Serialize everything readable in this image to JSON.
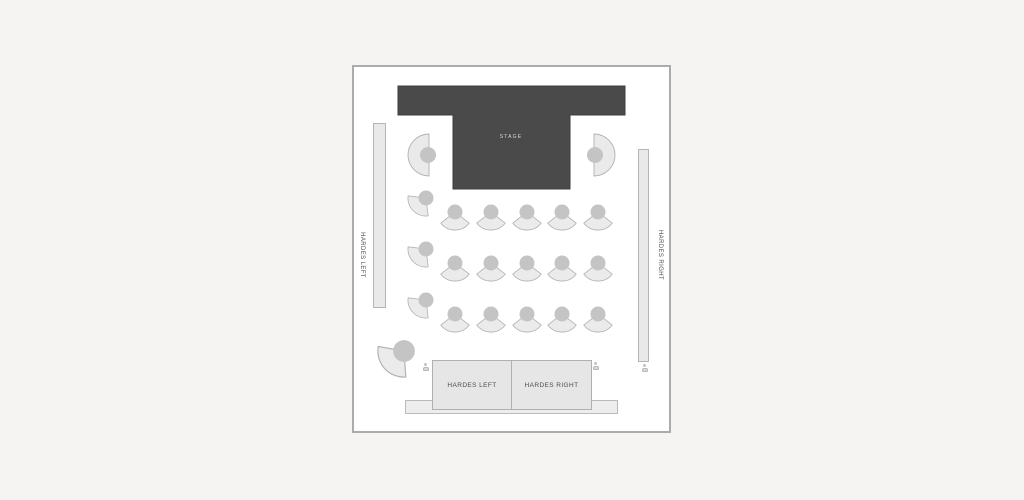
{
  "window": {
    "background": "#f5f4f2"
  },
  "canvas": {
    "background": "#ffffff",
    "border_color": "#ababab"
  },
  "stage": {
    "label": "STAGE",
    "fill": "#4a4a4a",
    "stroke": "#3e3e3e",
    "text_color": "#d9d9d9"
  },
  "side_rails": {
    "left": {
      "label": "HARDES LEFT"
    },
    "right": {
      "label": "HARDES RIGHT"
    }
  },
  "tables": {
    "left": {
      "label": "HARDES LEFT"
    },
    "right": {
      "label": "HARDES RIGHT"
    }
  },
  "seating": {
    "audience_rows": [
      {
        "y": 145,
        "x": [
          101,
          137,
          173,
          208,
          244
        ]
      },
      {
        "y": 196,
        "x": [
          101,
          137,
          173,
          208,
          244
        ]
      },
      {
        "y": 247,
        "x": [
          101,
          137,
          173,
          208,
          244
        ]
      }
    ],
    "aisle_chairs": [
      {
        "x": 72,
        "y": 131,
        "rotation": 45
      },
      {
        "x": 72,
        "y": 182,
        "rotation": 45
      },
      {
        "x": 72,
        "y": 233,
        "rotation": 45
      }
    ],
    "corner_chair": {
      "x": 50,
      "y": 284,
      "rotation": 48,
      "scale": 1.45
    },
    "booths": [
      {
        "side": "left",
        "flat_x": 75,
        "center_y": 88
      },
      {
        "side": "right",
        "flat_x": 240,
        "center_y": 88
      }
    ]
  },
  "markers": [
    {
      "x": 71,
      "y": 300
    },
    {
      "x": 241,
      "y": 299
    },
    {
      "x": 290,
      "y": 301
    }
  ],
  "palette": {
    "object_fill": "#ebebeb",
    "object_stroke": "#b1b1b1",
    "seat_circle": "#c4c4c4",
    "booth_fill": "#eaeaea"
  }
}
